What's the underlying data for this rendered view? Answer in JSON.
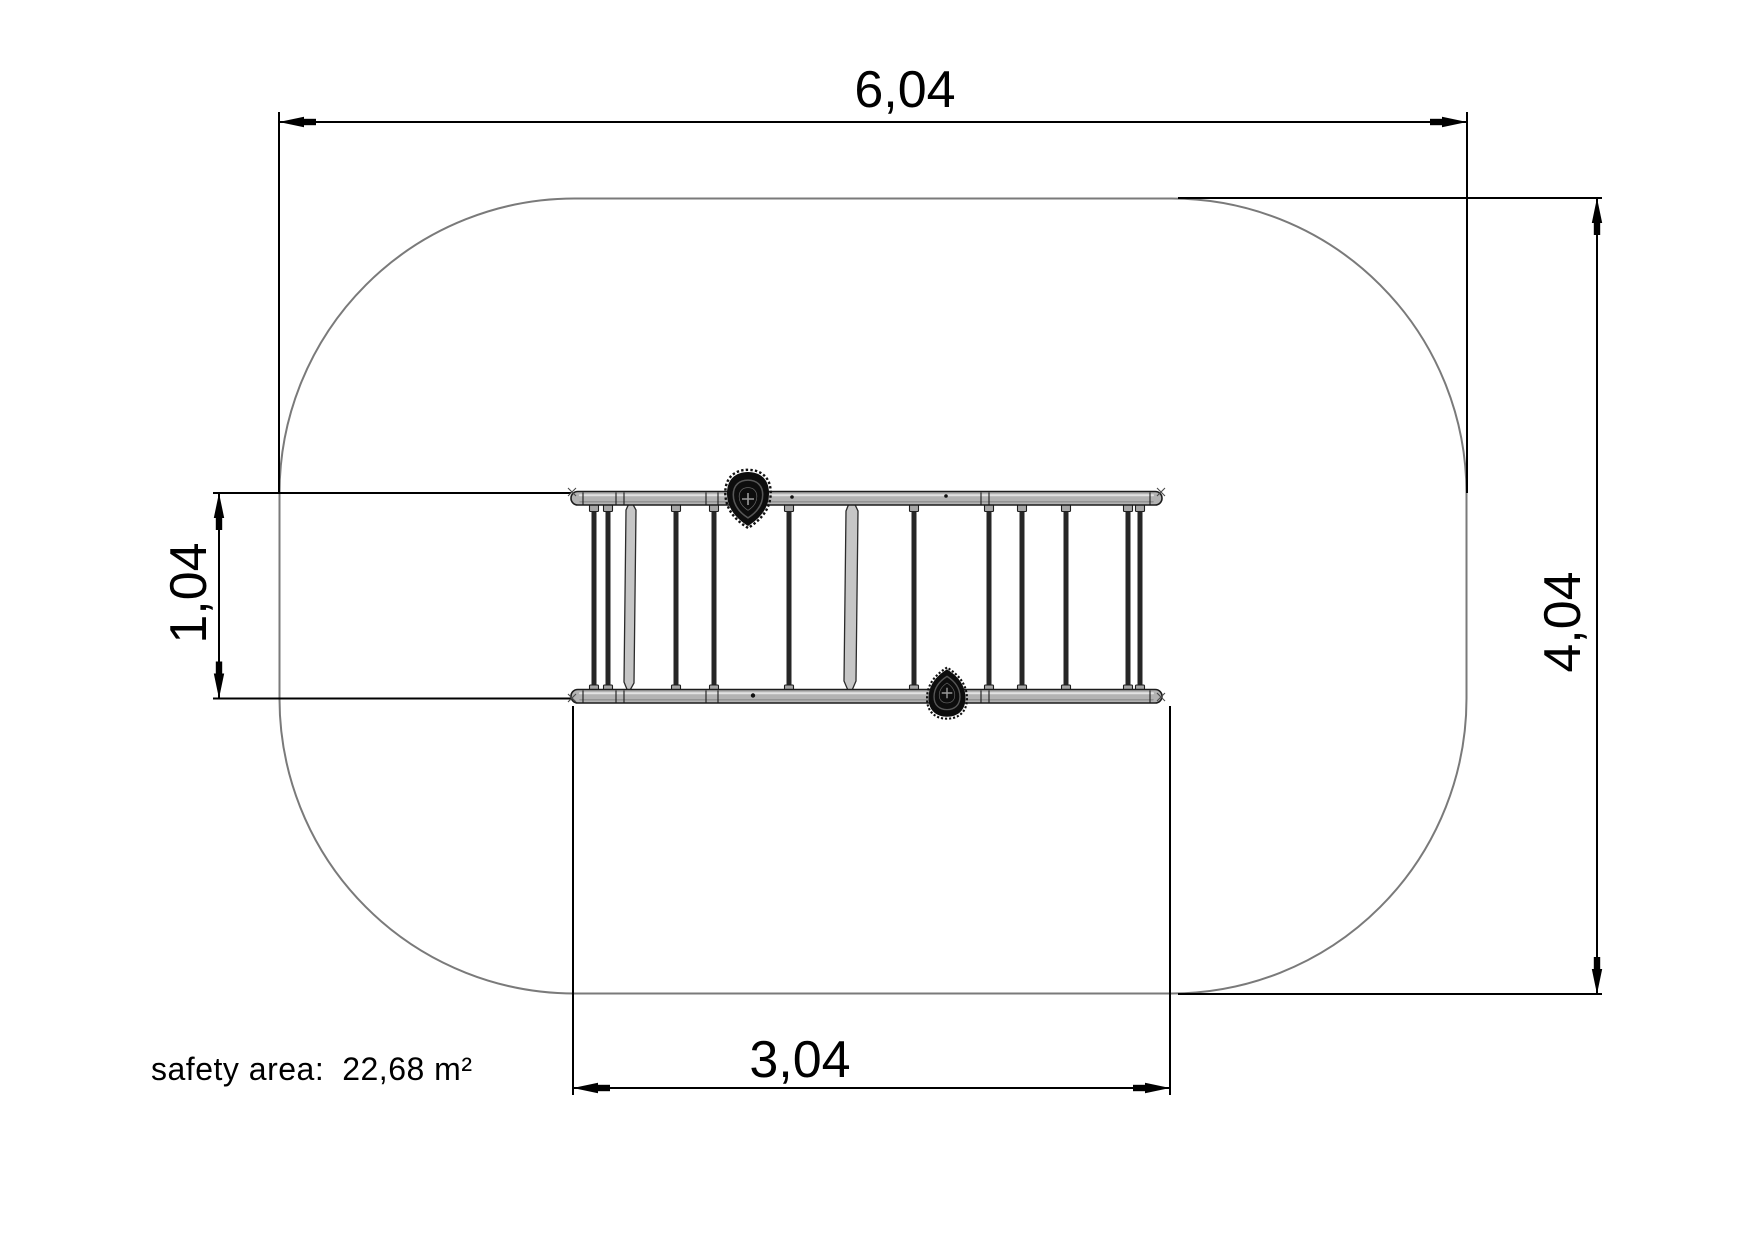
{
  "drawing": {
    "dimensions": {
      "top": {
        "value": "6,04"
      },
      "right": {
        "value": "4,04"
      },
      "left": {
        "value": "1,04"
      },
      "bottom": {
        "value": "3,04"
      }
    },
    "safety_area": {
      "label": "safety area:",
      "value": "22,68 m²"
    },
    "colors": {
      "safety_outline": "#7a7a7a",
      "dimension_line": "#000000",
      "equipment_rail": "#b3b3b3",
      "equipment_rung": "#262626",
      "grip": "#0d0d0d"
    }
  }
}
